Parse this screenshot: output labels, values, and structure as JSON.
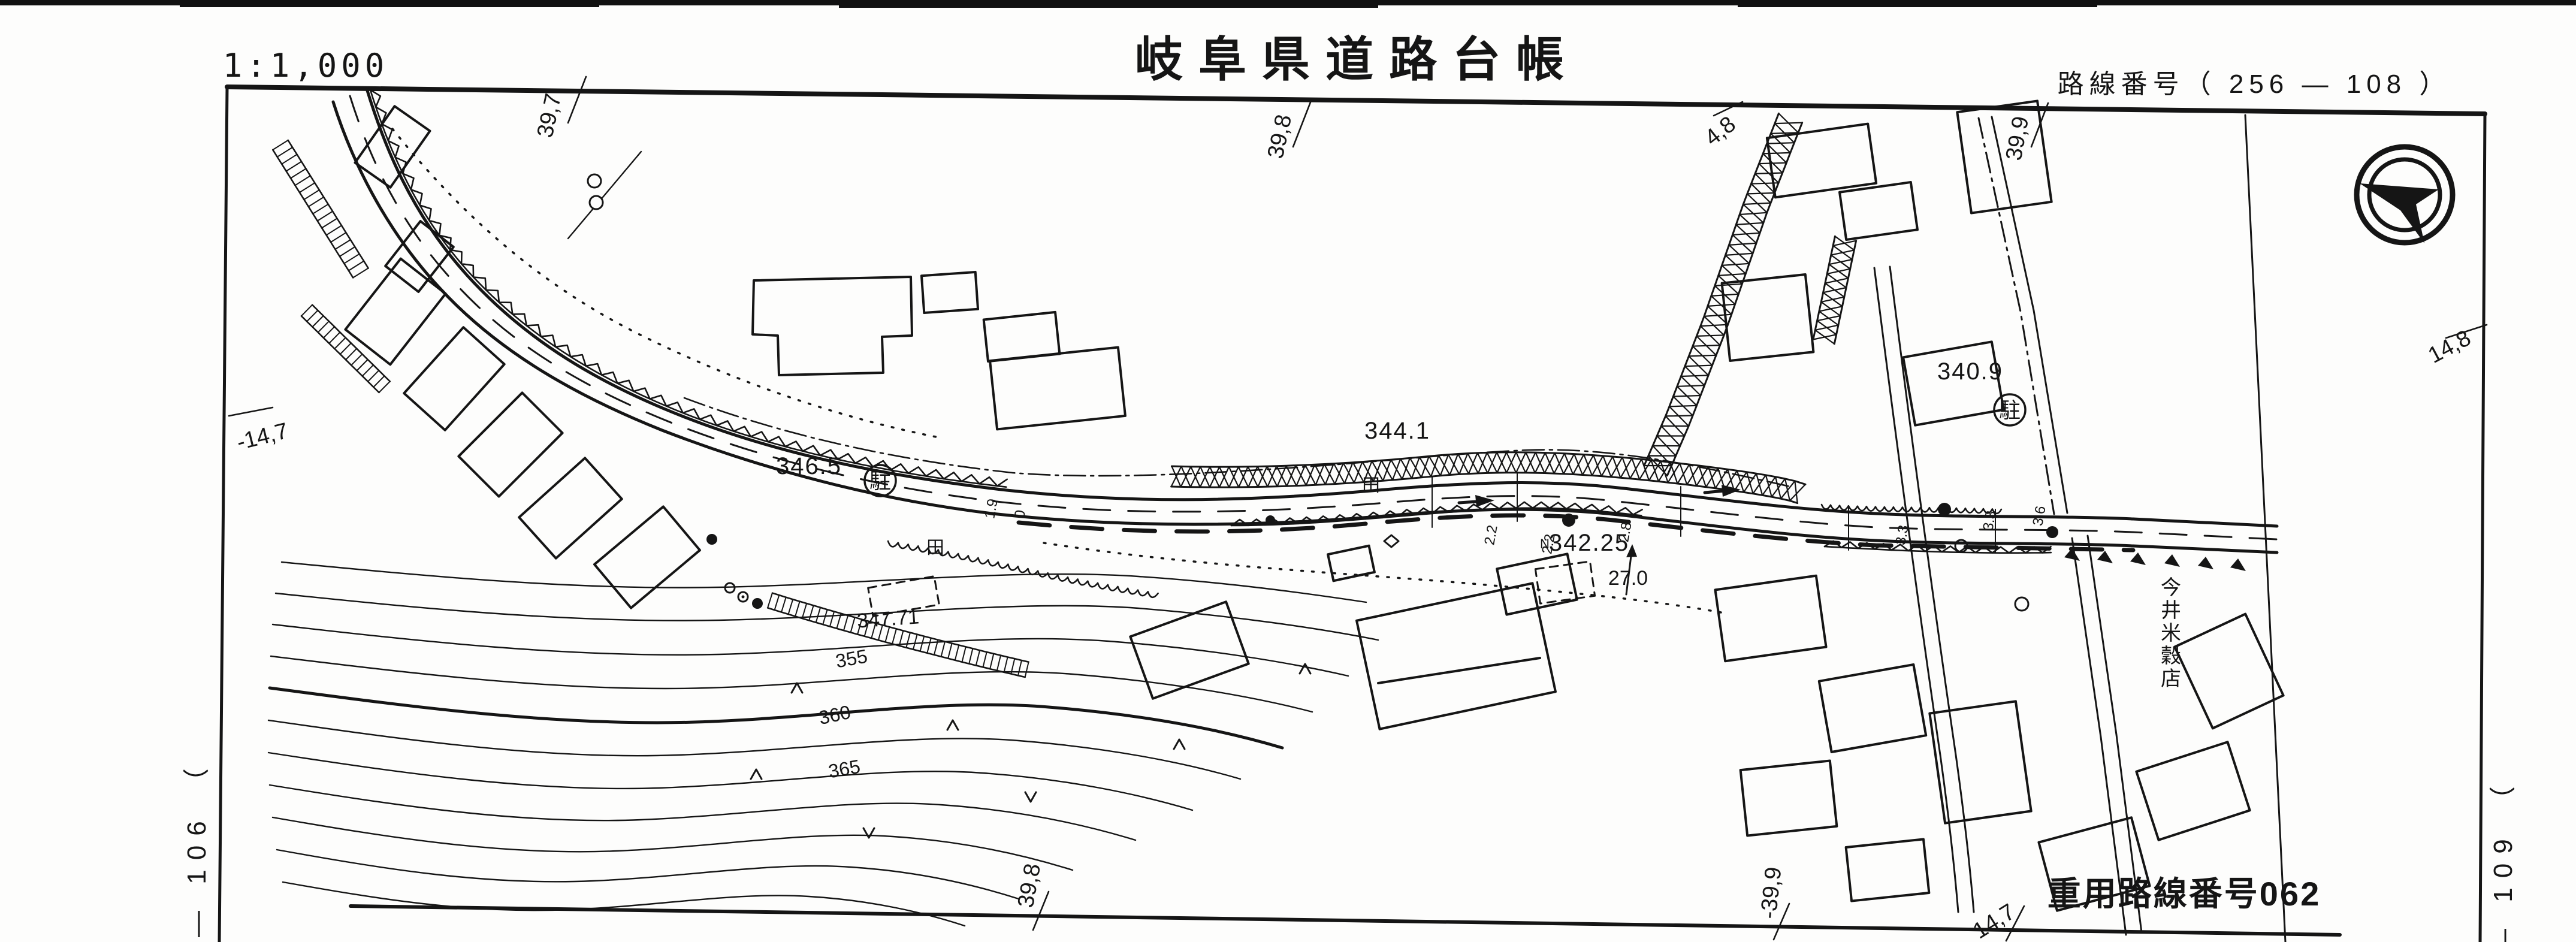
{
  "page": {
    "scale_label": "1:1,000",
    "title": "岐阜県道路台帳",
    "route_number_label": "路線番号（ 256 — 108 ）",
    "reuse_route_label": "重用路線番号062",
    "adjacent_sheet_left": "— 106 （",
    "adjacent_sheet_right": "— 109 （"
  },
  "boundary_ticks": [
    {
      "text": "39,7",
      "edge": "top"
    },
    {
      "text": "39,8",
      "edge": "top"
    },
    {
      "text": "4,8",
      "edge": "top"
    },
    {
      "text": "39,9",
      "edge": "top"
    },
    {
      "text": "14,8",
      "edge": "right"
    },
    {
      "text": "-14,7",
      "edge": "left"
    },
    {
      "text": "39,8",
      "edge": "bottom"
    },
    {
      "text": "-39,9",
      "edge": "bottom"
    },
    {
      "text": "14,7",
      "edge": "bottom"
    }
  ],
  "elevation_labels": [
    {
      "text": "346.5"
    },
    {
      "text": "344.1"
    },
    {
      "text": "342.25"
    },
    {
      "text": "347.71"
    },
    {
      "text": "340.9"
    },
    {
      "text": "27.0"
    }
  ],
  "benchmark_mark": "N",
  "contour_labels": [
    {
      "text": "355"
    },
    {
      "text": "360"
    },
    {
      "text": "365"
    }
  ],
  "road_width_labels": [
    {
      "text": "1.9"
    },
    {
      "text": "0"
    },
    {
      "text": "2.2"
    },
    {
      "text": "2.2"
    },
    {
      "text": "2.8"
    },
    {
      "text": "3.3"
    },
    {
      "text": "3.3"
    },
    {
      "text": "3.6"
    }
  ],
  "poi_labels": {
    "rice_store": "今井米穀店"
  },
  "map_symbols": {
    "parking_badge": "駐",
    "paddy_field": "田"
  },
  "icons": {
    "north_arrow": "north-arrow-icon"
  },
  "colors": {
    "ink": "#151515",
    "paper": "#fdfdfc"
  }
}
